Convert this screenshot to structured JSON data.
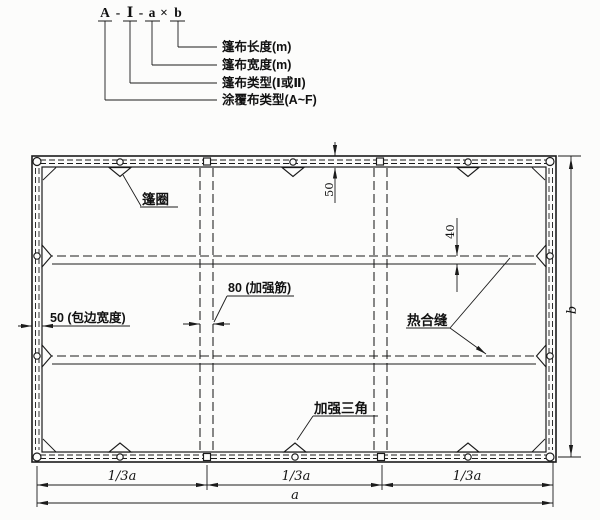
{
  "designation": {
    "fabric_type": "A",
    "sep": "-",
    "tarp_type": "Ⅰ",
    "width_sym": "a",
    "times": "×",
    "length_sym": "b",
    "callout_length": "篷布长度(m)",
    "callout_width": "篷布宽度(m)",
    "callout_type": "篷布类型(Ⅰ或Ⅱ)",
    "callout_fabric": "涂覆布类型(A~F)"
  },
  "drawing": {
    "ring_label": "篷圈",
    "hem_label": "50 (包边宽度)",
    "rib_label": "80 (加强筋)",
    "heat_seam_label": "热合缝",
    "triangle_label": "加强三角",
    "dim_border_width": "50",
    "dim_seam_width": "40",
    "dim_third": "1/3a",
    "dim_length": "a",
    "dim_width": "b"
  }
}
